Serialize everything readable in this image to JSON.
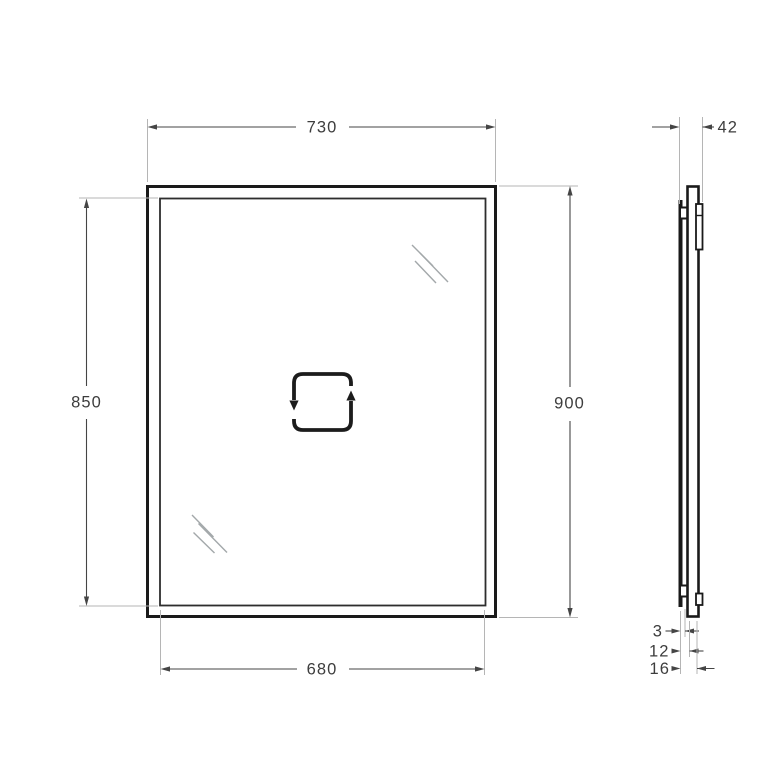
{
  "drawing_type": "mirror-technical-dimension-drawing",
  "front_view": {
    "width_outer": "730",
    "width_inner": "680",
    "height_inner": "850",
    "height_outer": "900"
  },
  "side_view": {
    "depth_total": "42",
    "back_panel_thickness": "3",
    "mid_depth": "12",
    "panel_depth": "16"
  },
  "icons": {
    "center_symbol": "rotate-square-arrows",
    "glass_shine": "diagonal-hatch-lines"
  },
  "colors": {
    "background": "#ffffff",
    "part_outline": "#1a1a1a",
    "inner_line": "#2e2e2e",
    "dimension_line": "#454545",
    "extension_line": "#b5b5b5",
    "hatch": "#a3a8aa",
    "text": "#3d3d3d"
  }
}
